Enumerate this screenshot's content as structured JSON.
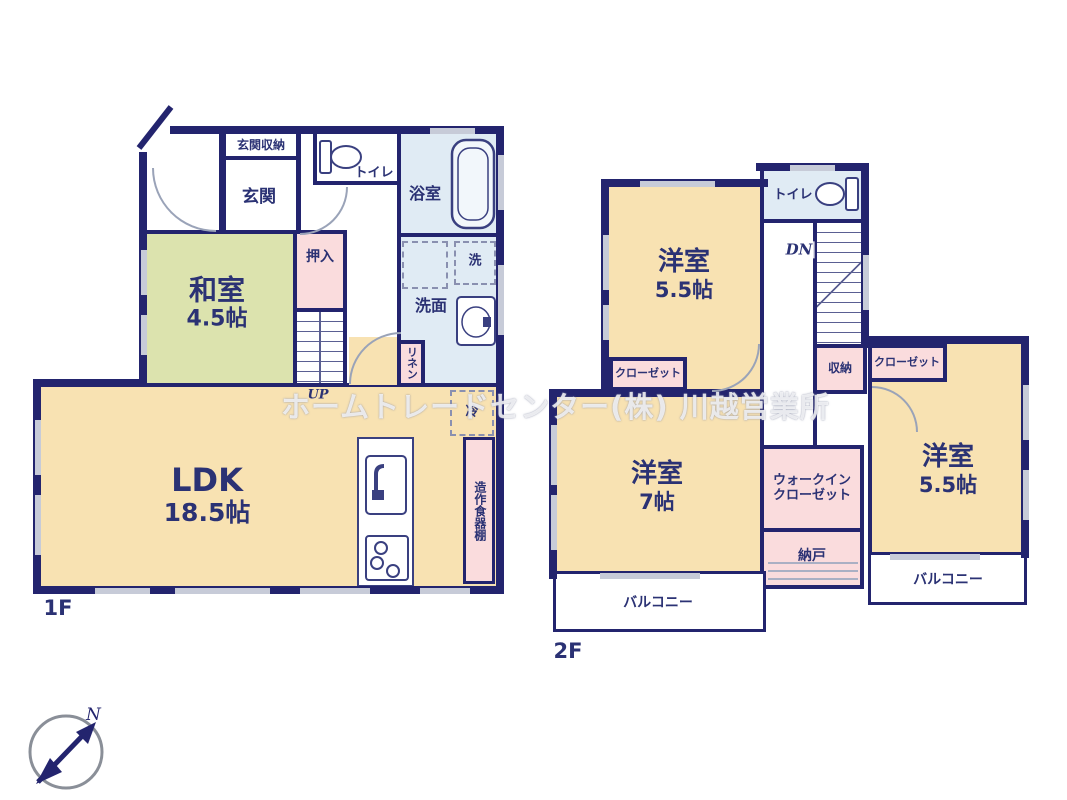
{
  "watermark": "ホームトレードセンター(株) 川越営業所",
  "compass": {
    "north": "N"
  },
  "colors": {
    "wall": "#23246e",
    "room_cream": "#f8e2b2",
    "room_tatami_green": "#dce3ae",
    "room_pink": "#fadcdd",
    "room_blue": "#e0ebf4",
    "window_marker": "#c7cbd8",
    "label_text": "#2b3274"
  },
  "floor1": {
    "label": "1F",
    "rooms": {
      "genkan_storage": "玄関収納",
      "genkan": "玄関",
      "toilet": "トイレ",
      "bath": "浴室",
      "washitsu": {
        "name": "和室",
        "size": "4.5帖"
      },
      "oshiire": "押入",
      "stairs": "UP",
      "laundry": "洗",
      "senmen": "洗面",
      "linen": "リネン",
      "fridge": "冷",
      "ldk": {
        "name": "LDK",
        "size": "18.5帖"
      },
      "cupboard": "造作食器棚"
    }
  },
  "floor2": {
    "label": "2F",
    "rooms": {
      "bedroom1": {
        "name": "洋室",
        "size": "5.5帖"
      },
      "toilet": "トイレ",
      "stairs": "DN",
      "closet1": "クローゼット",
      "storage": "収納",
      "closet2": "クローゼット",
      "bedroom2": {
        "name": "洋室",
        "size": "5.5帖"
      },
      "balcony_right": "バルコニー",
      "bedroom3": {
        "name": "洋室",
        "size": "7帖"
      },
      "wic": {
        "line1": "ウォークイン",
        "line2": "クローゼット"
      },
      "nando": "納戸",
      "balcony_left": "バルコニー"
    }
  }
}
